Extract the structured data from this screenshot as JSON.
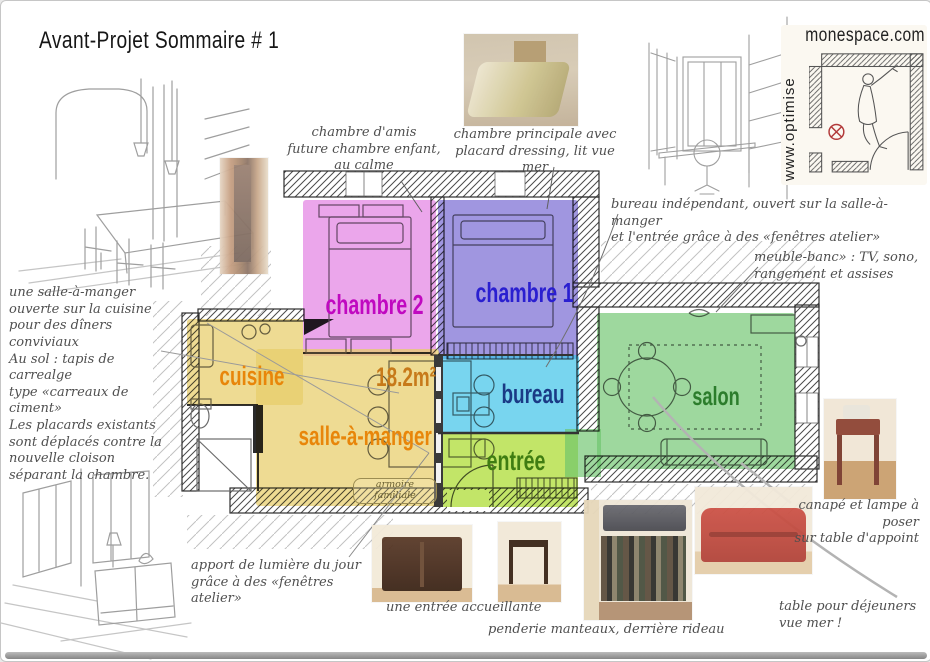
{
  "title": "Avant-Projet Sommaire # 1",
  "logo": {
    "site": "monespace.com",
    "tagline": "www.optimise"
  },
  "plan": {
    "area_label": "18.2m²",
    "armoire_note": "armoire\nfamiliale",
    "rooms": {
      "cuisine": {
        "label": "cuisine",
        "color": "#e8cd6a",
        "label_color": "#e8860a"
      },
      "salle": {
        "label": "salle-à-manger",
        "color": "#e8cd6a",
        "label_color": "#e8860a"
      },
      "chambre2": {
        "label": "chambre 2",
        "color": "#dd6add",
        "label_color": "#c009c0"
      },
      "chambre1": {
        "label": "chambre 1",
        "color": "#6f5fd0",
        "label_color": "#2a1fd0"
      },
      "bureau": {
        "label": "bureau",
        "color": "#3fc3e8",
        "label_color": "#1a3a85"
      },
      "entree": {
        "label": "entrée",
        "color": "#aadb2e",
        "label_color": "#3f7d12"
      },
      "salon": {
        "label": "salon",
        "color": "#6cc46c",
        "label_color": "#2c7d2c"
      }
    }
  },
  "annotations": {
    "chambre_amis": "chambre d'amis\nfuture chambre enfant,\nau calme",
    "chambre_principale": "chambre principale avec\nplacard dressing, lit vue mer",
    "bureau_note": "bureau indépendant, ouvert sur la salle-à-manger\net l'entrée grâce à des «fenêtres atelier»",
    "meuble_banc": "meuble-banc» : TV, sono,\nrangement et assises",
    "salle_note": "une salle-à-manger\nouverte sur la cuisine\npour des dîners conviviaux\nAu sol : tapis de carrealge\ntype «carreaux de ciment»\nLes placards existants\nsont déplacés contre la\nnouvelle cloison\nséparant la chambre.",
    "lumiere": "apport de lumière du jour\ngrâce à des «fenêtres atelier»",
    "entree_note": "une entrée accueillante",
    "penderie": "penderie manteaux, derrière rideau",
    "canape": "canapé et lampe à poser\nsur table d'appoint",
    "table_dej": "table pour déjeuners\nvue mer !"
  }
}
